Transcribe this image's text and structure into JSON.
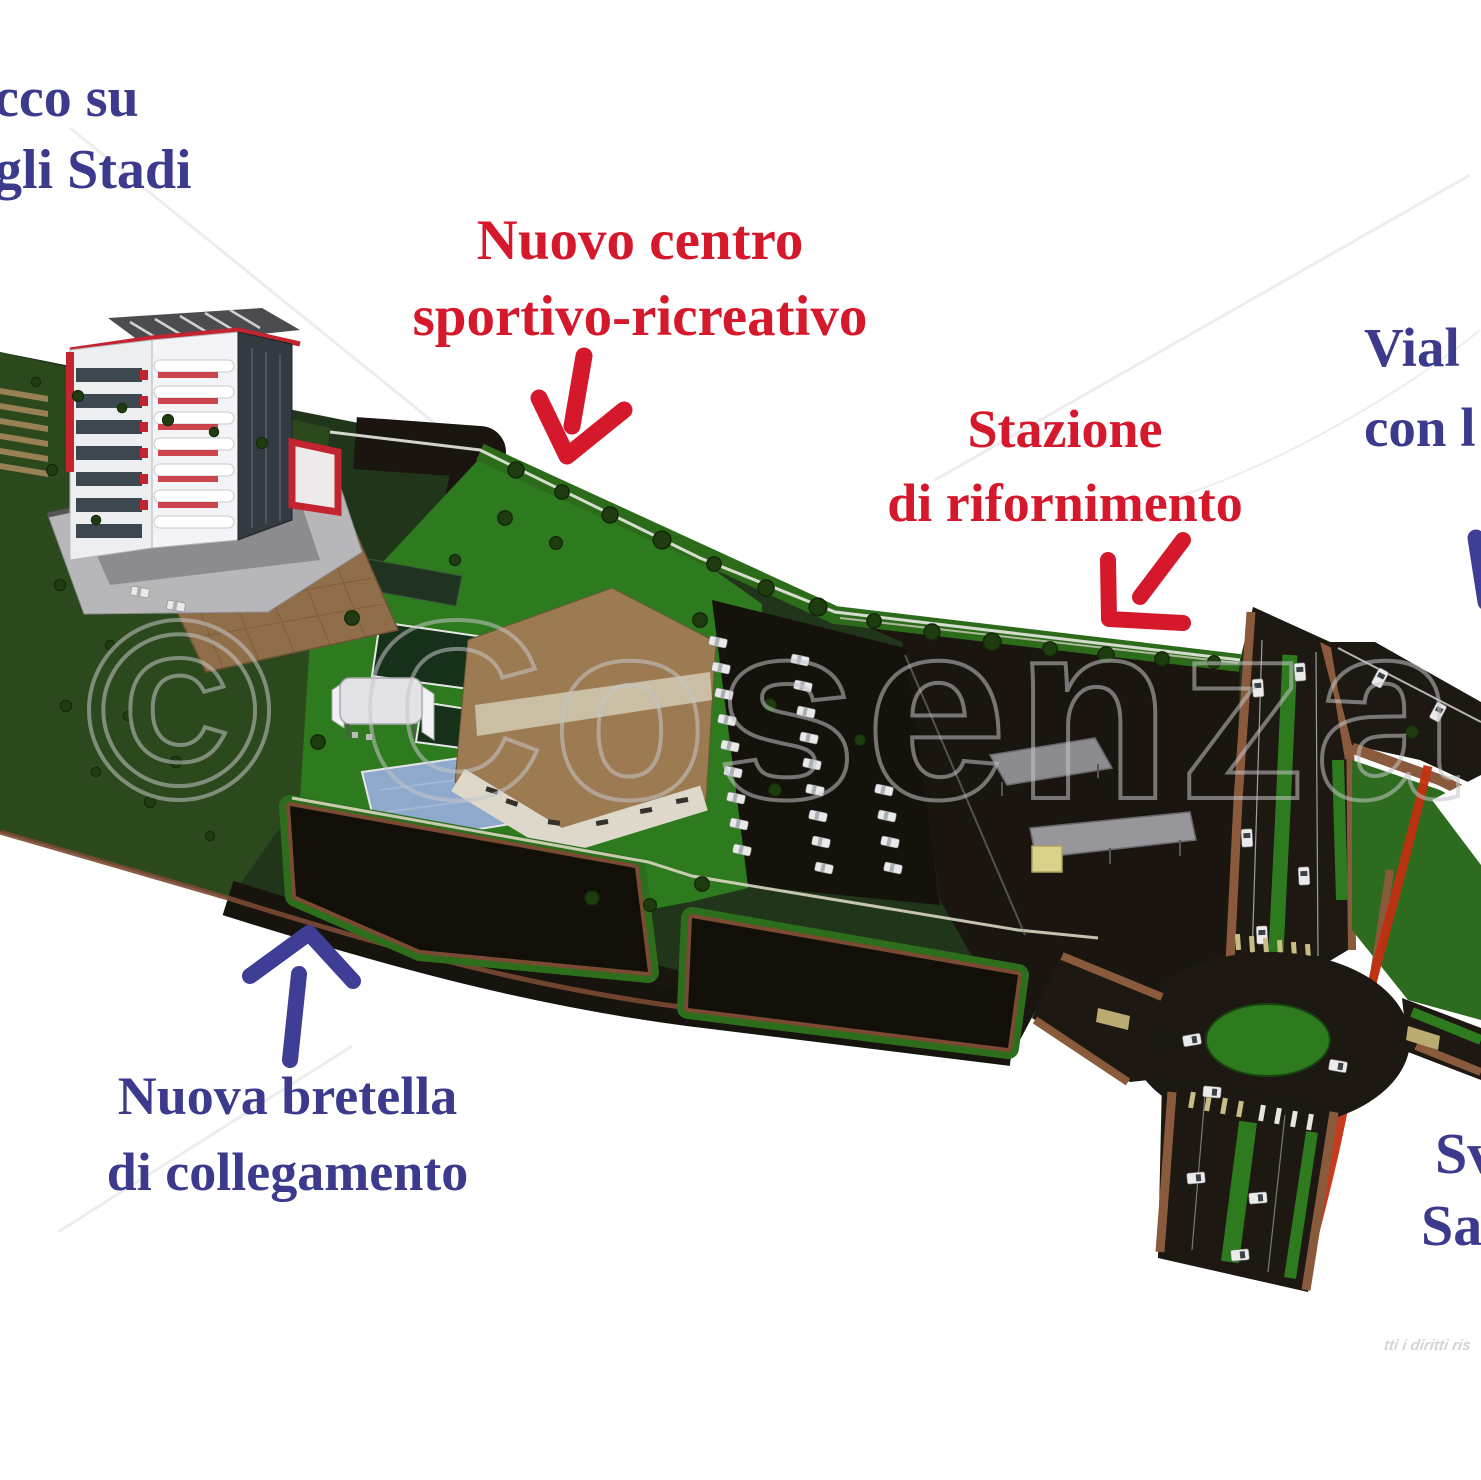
{
  "annotations": {
    "viale_degli_stadi": {
      "line1": "cco su",
      "line2": "gli Stadi"
    },
    "nuovo_centro": {
      "line1": "Nuovo centro",
      "line2": "sportivo-ricreativo"
    },
    "stazione_rifornimento": {
      "line1": "Stazione",
      "line2": "di rifornimento"
    },
    "viale_right": {
      "line1": "Vial",
      "line2": "con l"
    },
    "nuova_bretella": {
      "line1": "Nuova bretella",
      "line2": "di collegamento"
    },
    "svincolo": {
      "line1": "Sv",
      "line2": "Sa"
    }
  },
  "arrows": [
    {
      "name": "arrow-nuovo-centro",
      "color": "#d5182b",
      "direction": "down"
    },
    {
      "name": "arrow-stazione",
      "color": "#d5182b",
      "direction": "down-left"
    },
    {
      "name": "arrow-bretella",
      "color": "#3f3e96",
      "direction": "up"
    },
    {
      "name": "arrow-viale-partial",
      "color": "#3f3e96",
      "direction": "down"
    }
  ],
  "watermark": {
    "text": "© Cosenza Chan",
    "rights_text": "tti i diritti ris"
  },
  "colors": {
    "label_blue": "#3b3a8c",
    "label_red": "#d5182b",
    "grass_green": "#2e7a1e",
    "dark_green_base": "#20351a",
    "asphalt": "#1a150f",
    "curb_brown": "#8a5a3c",
    "bike_path_red": "#c23010",
    "pool_blue": "#8fa9cc",
    "sports_hall_tan": "#9c7b52",
    "terrace_brown": "#8f6e49",
    "tower_accent_red": "#c32430"
  }
}
